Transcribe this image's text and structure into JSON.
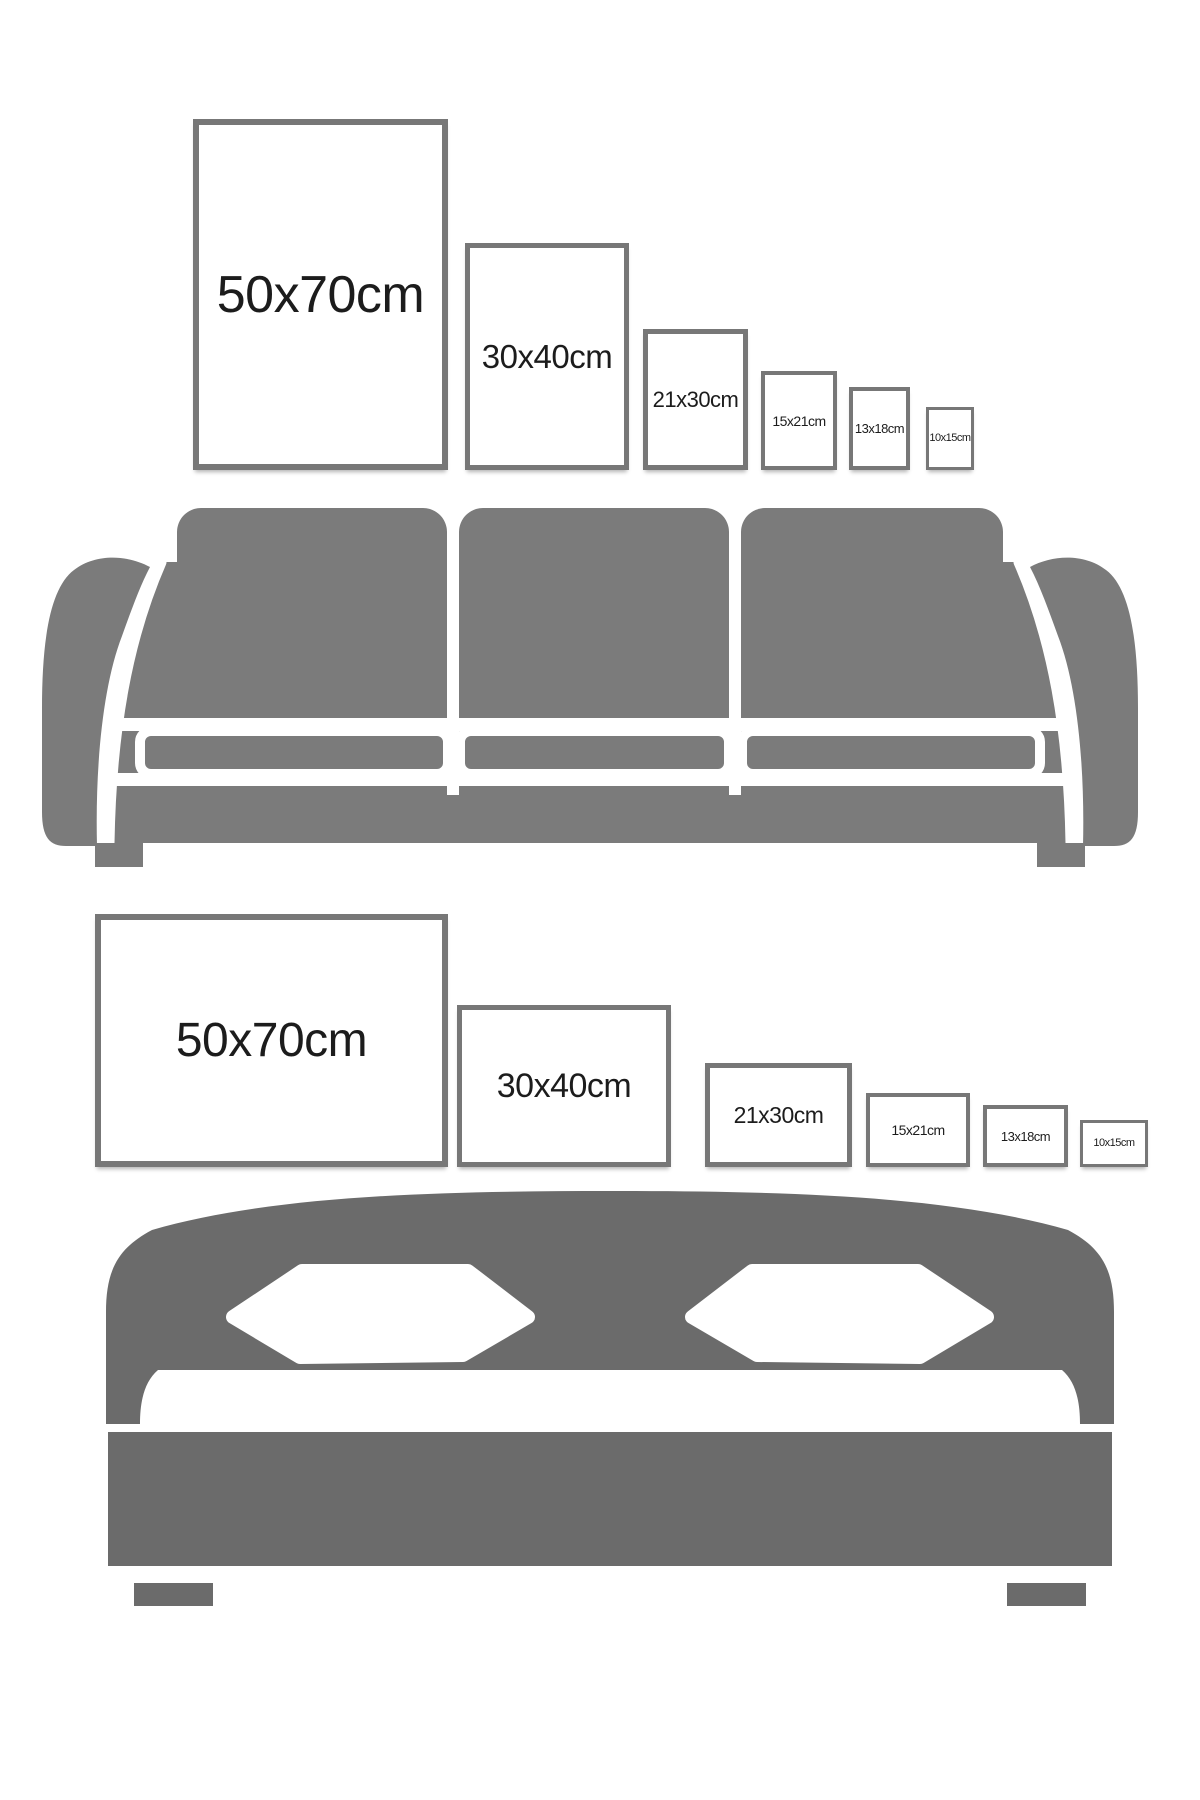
{
  "page": {
    "title": "Poster frame size comparison guide",
    "width": 1200,
    "height": 1800,
    "background": "#ffffff"
  },
  "colors": {
    "frame_border": "#777777",
    "frame_fill": "#ffffff",
    "label_text": "#1c1c1c",
    "sofa_gray": "#7b7b7b",
    "bed_gray": "#6b6b6b"
  },
  "sofa_section": {
    "furniture": "sofa",
    "frame_orientation": "portrait",
    "frames": [
      {
        "label": "50x70cm",
        "x": 193,
        "y": 119,
        "w": 255,
        "h": 351,
        "border": 6,
        "font": 52
      },
      {
        "label": "30x40cm",
        "x": 465,
        "y": 243,
        "w": 164,
        "h": 227,
        "border": 5,
        "font": 33
      },
      {
        "label": "21x30cm",
        "x": 643,
        "y": 329,
        "w": 105,
        "h": 141,
        "border": 5,
        "font": 22
      },
      {
        "label": "15x21cm",
        "x": 761,
        "y": 371,
        "w": 76,
        "h": 99,
        "border": 4,
        "font": 14
      },
      {
        "label": "13x18cm",
        "x": 849,
        "y": 387,
        "w": 61,
        "h": 83,
        "border": 4,
        "font": 13
      },
      {
        "label": "10x15cm",
        "x": 926,
        "y": 407,
        "w": 48,
        "h": 63,
        "border": 3,
        "font": 11
      }
    ]
  },
  "bed_section": {
    "furniture": "bed",
    "frame_orientation": "landscape",
    "frames": [
      {
        "label": "50x70cm",
        "x": 95,
        "y": 914,
        "w": 353,
        "h": 253,
        "border": 6,
        "font": 48
      },
      {
        "label": "30x40cm",
        "x": 457,
        "y": 1005,
        "w": 214,
        "h": 162,
        "border": 5,
        "font": 34
      },
      {
        "label": "21x30cm",
        "x": 705,
        "y": 1063,
        "w": 147,
        "h": 104,
        "border": 5,
        "font": 23
      },
      {
        "label": "15x21cm",
        "x": 866,
        "y": 1093,
        "w": 104,
        "h": 74,
        "border": 4,
        "font": 14
      },
      {
        "label": "13x18cm",
        "x": 983,
        "y": 1105,
        "w": 85,
        "h": 62,
        "border": 4,
        "font": 13
      },
      {
        "label": "10x15cm",
        "x": 1080,
        "y": 1120,
        "w": 68,
        "h": 47,
        "border": 3,
        "font": 11
      }
    ]
  }
}
